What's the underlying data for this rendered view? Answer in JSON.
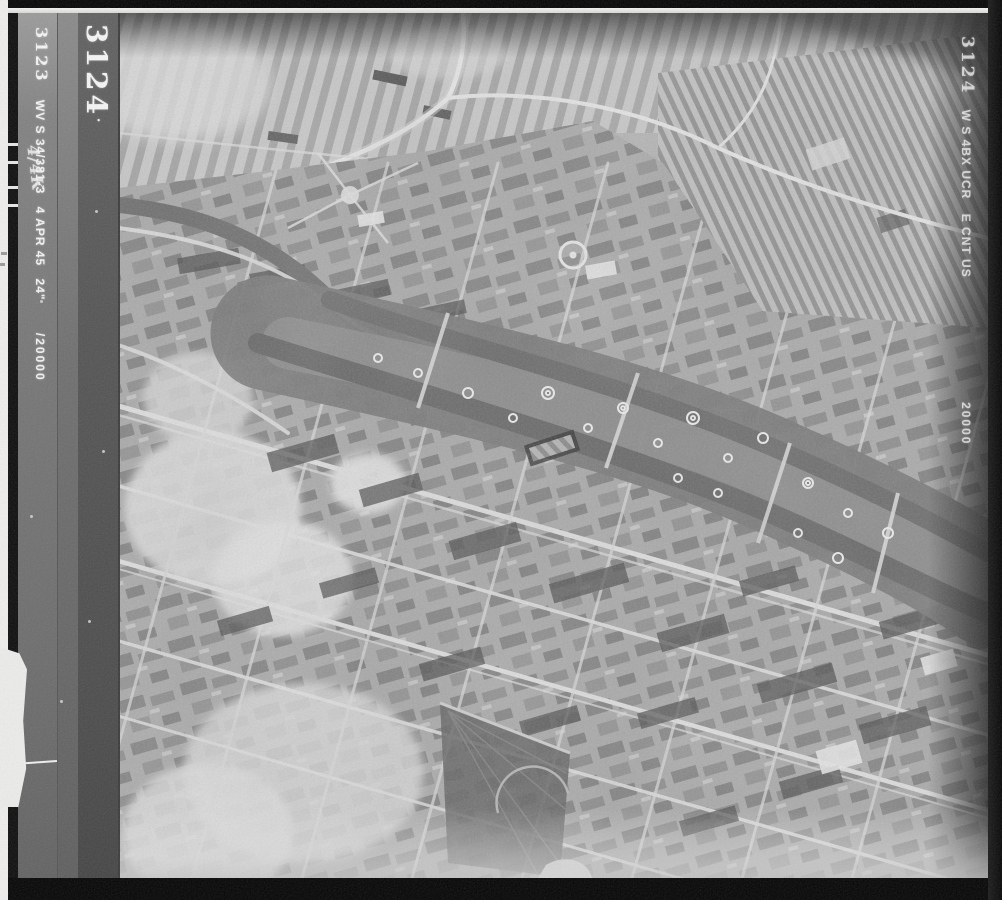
{
  "film_margin": {
    "adjacent_frame": {
      "frame_number": "3123",
      "sortie_code": "WV S 34/381-3",
      "scribble": "4/4K",
      "date": "4 APR 45",
      "focal_length": "24\"",
      "scale": "/20000"
    },
    "current_frame": {
      "frame_number_large": "3124",
      "speck": "."
    },
    "right_edge": {
      "frame_number": "3124",
      "sortie_code": "W S 4BX UCR",
      "fragments": "E CNT US",
      "scale": "20000"
    }
  },
  "colors": {
    "scan_background": "#0a0a0a",
    "paper_edge": "#efeeec",
    "margin_strip_light": "#828282",
    "margin_strip_dark": "#4c4c4c",
    "photo_base": "#b2b2b2",
    "fields_light": "#cdcdcd",
    "water_band": "#707070",
    "street_light": "#e2e2e2",
    "city_block_dark": "#4d4d4d",
    "annotation_text": "#f3f3f3"
  }
}
